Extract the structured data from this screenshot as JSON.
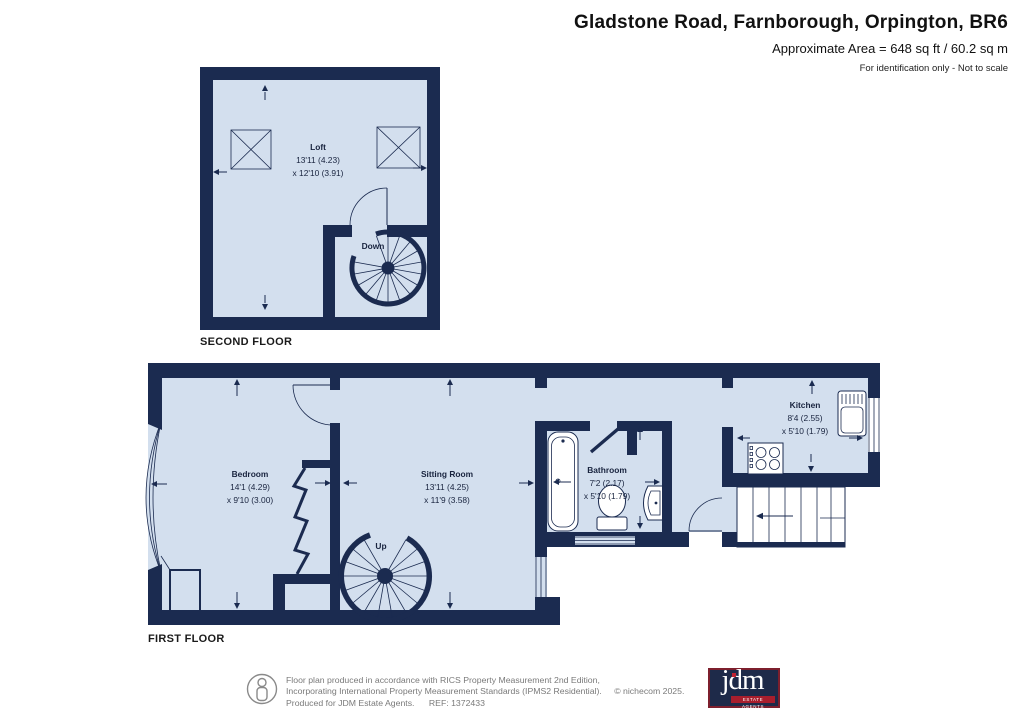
{
  "header": {
    "title": "Gladstone Road, Farnborough, Orpington, BR6",
    "area_line": "Approximate Area = 648 sq ft / 60.2 sq m",
    "note": "For identification only - Not to scale"
  },
  "second_floor": {
    "label": "SECOND FLOOR",
    "room": {
      "name": "Loft",
      "dim1": "13'11 (4.23)",
      "dim2": "x 12'10 (3.91)"
    },
    "stair_label": "Down"
  },
  "first_floor": {
    "label": "FIRST FLOOR",
    "bedroom": {
      "name": "Bedroom",
      "dim1": "14'1 (4.29)",
      "dim2": "x 9'10 (3.00)"
    },
    "sitting_room": {
      "name": "Sitting Room",
      "dim1": "13'11 (4.25)",
      "dim2": "x 11'9 (3.58)"
    },
    "bathroom": {
      "name": "Bathroom",
      "dim1": "7'2 (2.17)",
      "dim2": "x 5'10 (1.79)"
    },
    "kitchen": {
      "name": "Kitchen",
      "dim1": "8'4 (2.55)",
      "dim2": "x 5'10 (1.79)"
    },
    "stair_label": "Up"
  },
  "footer": {
    "line1": "Floor plan produced in accordance with RICS Property Measurement 2nd Edition,",
    "line2": "Incorporating International Property Measurement Standards (IPMS2 Residential).",
    "copyright": "© nichecom 2025.",
    "produced": "Produced for JDM Estate Agents.",
    "ref": "REF: 1372433",
    "logo_text": "jdm",
    "logo_subtext": "ESTATE AGENTS"
  },
  "colors": {
    "wall": "#1b2b50",
    "floor": "#d3dfee",
    "logo_bg": "#1e2a49",
    "logo_border": "#7d1f2d",
    "logo_red": "#c02231"
  }
}
